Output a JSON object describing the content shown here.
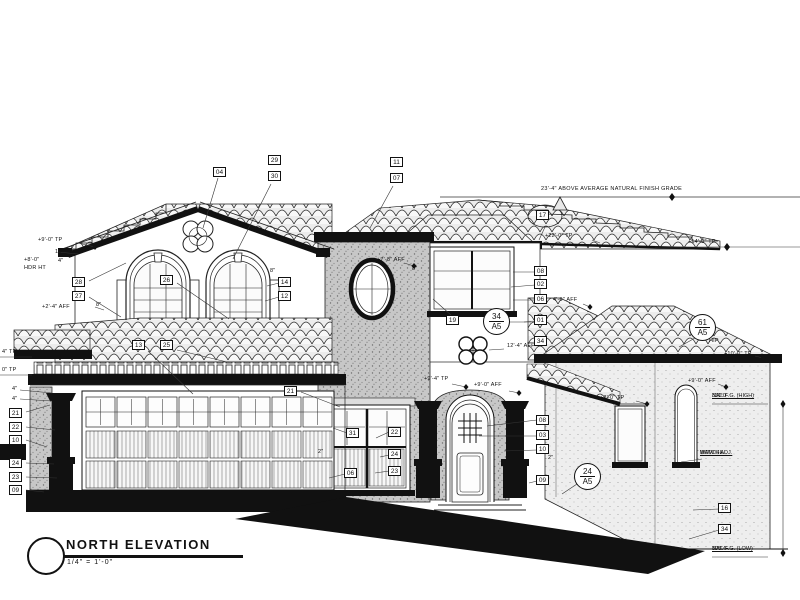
{
  "drawing": {
    "title": "NORTH ELEVATION",
    "scale": "1/4\" = 1'-0\"",
    "top_note": "23'-4\" ABOVE AVERAGE NATURAL FINISH GRADE"
  },
  "annotations": {
    "boxes": [
      {
        "label": "04",
        "x": 222,
        "y": 173
      },
      {
        "label": "29",
        "x": 277,
        "y": 161
      },
      {
        "label": "30",
        "x": 277,
        "y": 177
      },
      {
        "label": "11",
        "x": 399,
        "y": 163
      },
      {
        "label": "07",
        "x": 399,
        "y": 179
      },
      {
        "label": "17",
        "x": 545,
        "y": 216
      },
      {
        "label": "28",
        "x": 81,
        "y": 283
      },
      {
        "label": "27",
        "x": 81,
        "y": 297
      },
      {
        "label": "26",
        "x": 169,
        "y": 281
      },
      {
        "label": "14",
        "x": 287,
        "y": 283
      },
      {
        "label": "12",
        "x": 287,
        "y": 297
      },
      {
        "label": "13",
        "x": 141,
        "y": 346
      },
      {
        "label": "25",
        "x": 169,
        "y": 346
      },
      {
        "label": "08",
        "x": 543,
        "y": 272
      },
      {
        "label": "02",
        "x": 543,
        "y": 285
      },
      {
        "label": "06",
        "x": 543,
        "y": 300
      },
      {
        "label": "01",
        "x": 543,
        "y": 321
      },
      {
        "label": "34",
        "x": 543,
        "y": 342
      },
      {
        "label": "19",
        "x": 455,
        "y": 321
      },
      {
        "label": "21",
        "x": 293,
        "y": 392
      },
      {
        "label": "31",
        "x": 355,
        "y": 434
      },
      {
        "label": "22",
        "x": 397,
        "y": 433
      },
      {
        "label": "24",
        "x": 397,
        "y": 455
      },
      {
        "label": "23",
        "x": 397,
        "y": 472
      },
      {
        "label": "06",
        "x": 353,
        "y": 474
      },
      {
        "label": "08",
        "x": 545,
        "y": 421
      },
      {
        "label": "03",
        "x": 545,
        "y": 436
      },
      {
        "label": "10",
        "x": 545,
        "y": 450
      },
      {
        "label": "09",
        "x": 545,
        "y": 481
      },
      {
        "label": "21",
        "x": 18,
        "y": 414
      },
      {
        "label": "22",
        "x": 18,
        "y": 428
      },
      {
        "label": "10",
        "x": 18,
        "y": 441
      },
      {
        "label": "24",
        "x": 18,
        "y": 464
      },
      {
        "label": "23",
        "x": 18,
        "y": 478
      },
      {
        "label": "09",
        "x": 18,
        "y": 491
      },
      {
        "label": "16",
        "x": 727,
        "y": 509
      },
      {
        "label": "34",
        "x": 727,
        "y": 530
      }
    ],
    "circles": [
      {
        "top": "34",
        "bottom": "A5",
        "x": 497,
        "y": 322
      },
      {
        "top": "24",
        "bottom": "A5",
        "x": 588,
        "y": 477
      },
      {
        "top": "61",
        "bottom": "A5",
        "x": 703,
        "y": 328
      }
    ],
    "dims": [
      {
        "t": "+9'-0\" TP",
        "x": 38,
        "y": 237
      },
      {
        "t": "10\"",
        "x": 55,
        "y": 249
      },
      {
        "t": "+8'-0\"",
        "x": 24,
        "y": 257
      },
      {
        "t": "4\"",
        "x": 58,
        "y": 258
      },
      {
        "t": "HDR HT",
        "x": 24,
        "y": 265
      },
      {
        "t": "+2'-4\" AFF",
        "x": 42,
        "y": 304
      },
      {
        "t": "8\"",
        "x": 96,
        "y": 302
      },
      {
        "t": "8\"",
        "x": 270,
        "y": 268
      },
      {
        "t": "8\"",
        "x": 412,
        "y": 266
      },
      {
        "t": "4\" TP",
        "x": 2,
        "y": 349
      },
      {
        "t": "0\" TP",
        "x": 2,
        "y": 367
      },
      {
        "t": "4\"",
        "x": 12,
        "y": 386
      },
      {
        "t": "4\"",
        "x": 12,
        "y": 396
      },
      {
        "t": "+22'-0\" TP",
        "x": 545,
        "y": 233
      },
      {
        "t": "+14'-0\" TP",
        "x": 688,
        "y": 239
      },
      {
        "t": "+7'-8\" AFF",
        "x": 377,
        "y": 257
      },
      {
        "t": "+9'-4\" TP",
        "x": 424,
        "y": 376
      },
      {
        "t": "+9'-0\" AFF",
        "x": 474,
        "y": 382
      },
      {
        "t": "12'-4\" AFF",
        "x": 507,
        "y": 343
      },
      {
        "t": "4'-0\" AFF",
        "x": 553,
        "y": 297
      },
      {
        "t": "2\"",
        "x": 318,
        "y": 449
      },
      {
        "t": "2\"",
        "x": 548,
        "y": 455
      },
      {
        "t": "+8'-0\" TP",
        "x": 600,
        "y": 395
      },
      {
        "t": "+9'-0\" AFF",
        "x": 688,
        "y": 378
      },
      {
        "t": "+10'-0\" TP",
        "x": 724,
        "y": 351
      },
      {
        "t": "HIP",
        "x": 709,
        "y": 338
      }
    ],
    "notes": [
      {
        "lines": [
          "331.0'",
          "NAT. F.G. (HIGH)"
        ],
        "x": 712,
        "y": 393
      },
      {
        "lines": [
          "MATCH ADJ.",
          "WDW SILL"
        ],
        "x": 700,
        "y": 450
      },
      {
        "lines": [
          "308.4'",
          "NAT. F.G. (LOW)"
        ],
        "x": 712,
        "y": 546
      }
    ]
  }
}
